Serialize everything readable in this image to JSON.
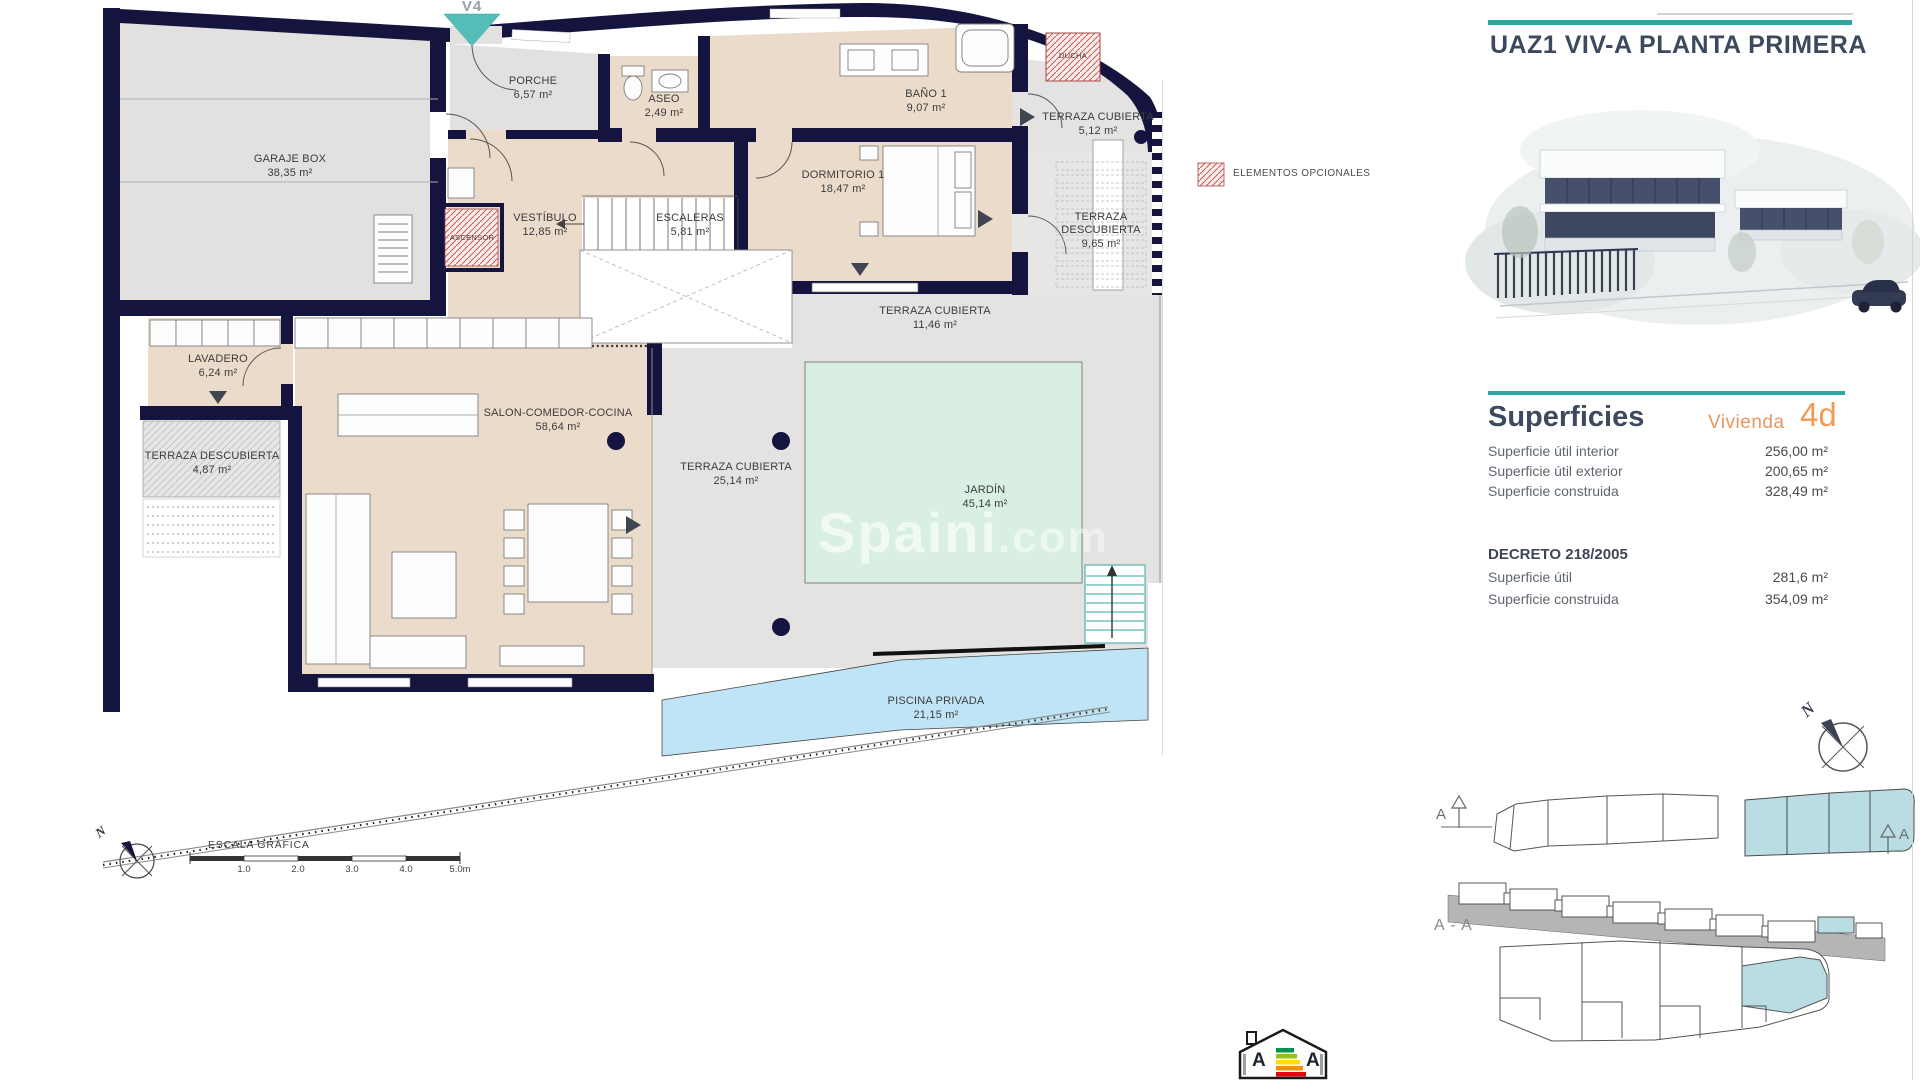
{
  "plan": {
    "v4_label": "V4",
    "legend_optional": "ELEMENTOS OPCIONALES",
    "watermark_main": "Spaini",
    "watermark_suffix": ".com",
    "rooms": [
      {
        "name": "GARAJE BOX",
        "area": "38,35 m²",
        "x": 290,
        "y": 153,
        "w": 130
      },
      {
        "name": "PORCHE",
        "area": "6,57 m²",
        "x": 533,
        "y": 75,
        "w": 100
      },
      {
        "name": "ASEO",
        "area": "2,49 m²",
        "x": 664,
        "y": 93,
        "w": 80
      },
      {
        "name": "BAÑO 1",
        "area": "9,07 m²",
        "x": 926,
        "y": 88,
        "w": 90
      },
      {
        "name": "DUCHA",
        "area": "",
        "x": 1073,
        "y": 51,
        "w": 60,
        "small": true
      },
      {
        "name": "TERRAZA CUBIERTA",
        "area": "5,12 m²",
        "x": 1098,
        "y": 111,
        "w": 170
      },
      {
        "name": "DORMITORIO 1",
        "area": "18,47 m²",
        "x": 843,
        "y": 169,
        "w": 140
      },
      {
        "name": "TERRAZA DESCUBIERTA",
        "area": "9,65 m²",
        "x": 1101,
        "y": 211,
        "w": 112
      },
      {
        "name": "VESTÍBULO",
        "area": "12,85 m²",
        "x": 545,
        "y": 212,
        "w": 110
      },
      {
        "name": "ESCALERAS",
        "area": "5,81 m²",
        "x": 690,
        "y": 212,
        "w": 110
      },
      {
        "name": "ASCENSOR",
        "area": "",
        "x": 472,
        "y": 233,
        "w": 70,
        "small": true
      },
      {
        "name": "TERRAZA CUBIERTA",
        "area": "11,46 m²",
        "x": 935,
        "y": 305,
        "w": 190
      },
      {
        "name": "LAVADERO",
        "area": "6,24 m²",
        "x": 218,
        "y": 353,
        "w": 110
      },
      {
        "name": "SALON-COMEDOR-COCINA",
        "area": "58,64 m²",
        "x": 558,
        "y": 407,
        "w": 240
      },
      {
        "name": "TERRAZA DESCUBIERTA",
        "area": "4,87 m²",
        "x": 212,
        "y": 450,
        "w": 135
      },
      {
        "name": "TERRAZA CUBIERTA",
        "area": "25,14 m²",
        "x": 736,
        "y": 461,
        "w": 180
      },
      {
        "name": "JARDÍN",
        "area": "45,14 m²",
        "x": 985,
        "y": 484,
        "w": 100
      },
      {
        "name": "PISCINA PRIVADA",
        "area": "21,15 m²",
        "x": 936,
        "y": 695,
        "w": 170
      }
    ]
  },
  "right_panel": {
    "title": "UAZ1 VIV-A PLANTA PRIMERA"
  },
  "superficies": {
    "heading": "Superficies",
    "vivienda_label": "Vivienda",
    "vivienda_value": "4d",
    "rows": [
      {
        "label": "Superficie útil interior",
        "value": "256,00 m²"
      },
      {
        "label": "Superficie útil exterior",
        "value": "200,65 m²"
      },
      {
        "label": "Superficie construida",
        "value": "328,49 m²"
      }
    ],
    "decreto": {
      "heading": "DECRETO 218/2005",
      "rows": [
        {
          "label": "Superficie útil",
          "value": "281,6 m²"
        },
        {
          "label": "Superficie construida",
          "value": "354,09 m²"
        }
      ]
    }
  },
  "site": {
    "section_label": "A - A",
    "marker_left": "A",
    "marker_right": "A",
    "north_label": "N"
  },
  "scale_bar": {
    "title": "ESCALA GRÁFICA",
    "ticks": [
      "1.0",
      "2.0",
      "3.0",
      "4.0",
      "5.0m"
    ]
  },
  "compass": {
    "north_label": "N"
  },
  "energy": {
    "letters": [
      "A",
      "A"
    ]
  },
  "colors": {
    "wall_navy": "#14143e",
    "floor_beige": "#ebdbca",
    "floor_gray": "#e4e3e1",
    "garden_mint": "#d8efe2",
    "pool_blue": "#bfe4f5",
    "accent_teal": "#2ba8a2",
    "accent_orange": "#f09b52",
    "hatch_red": "#c4625e",
    "site_highlight": "#b9dde2"
  }
}
